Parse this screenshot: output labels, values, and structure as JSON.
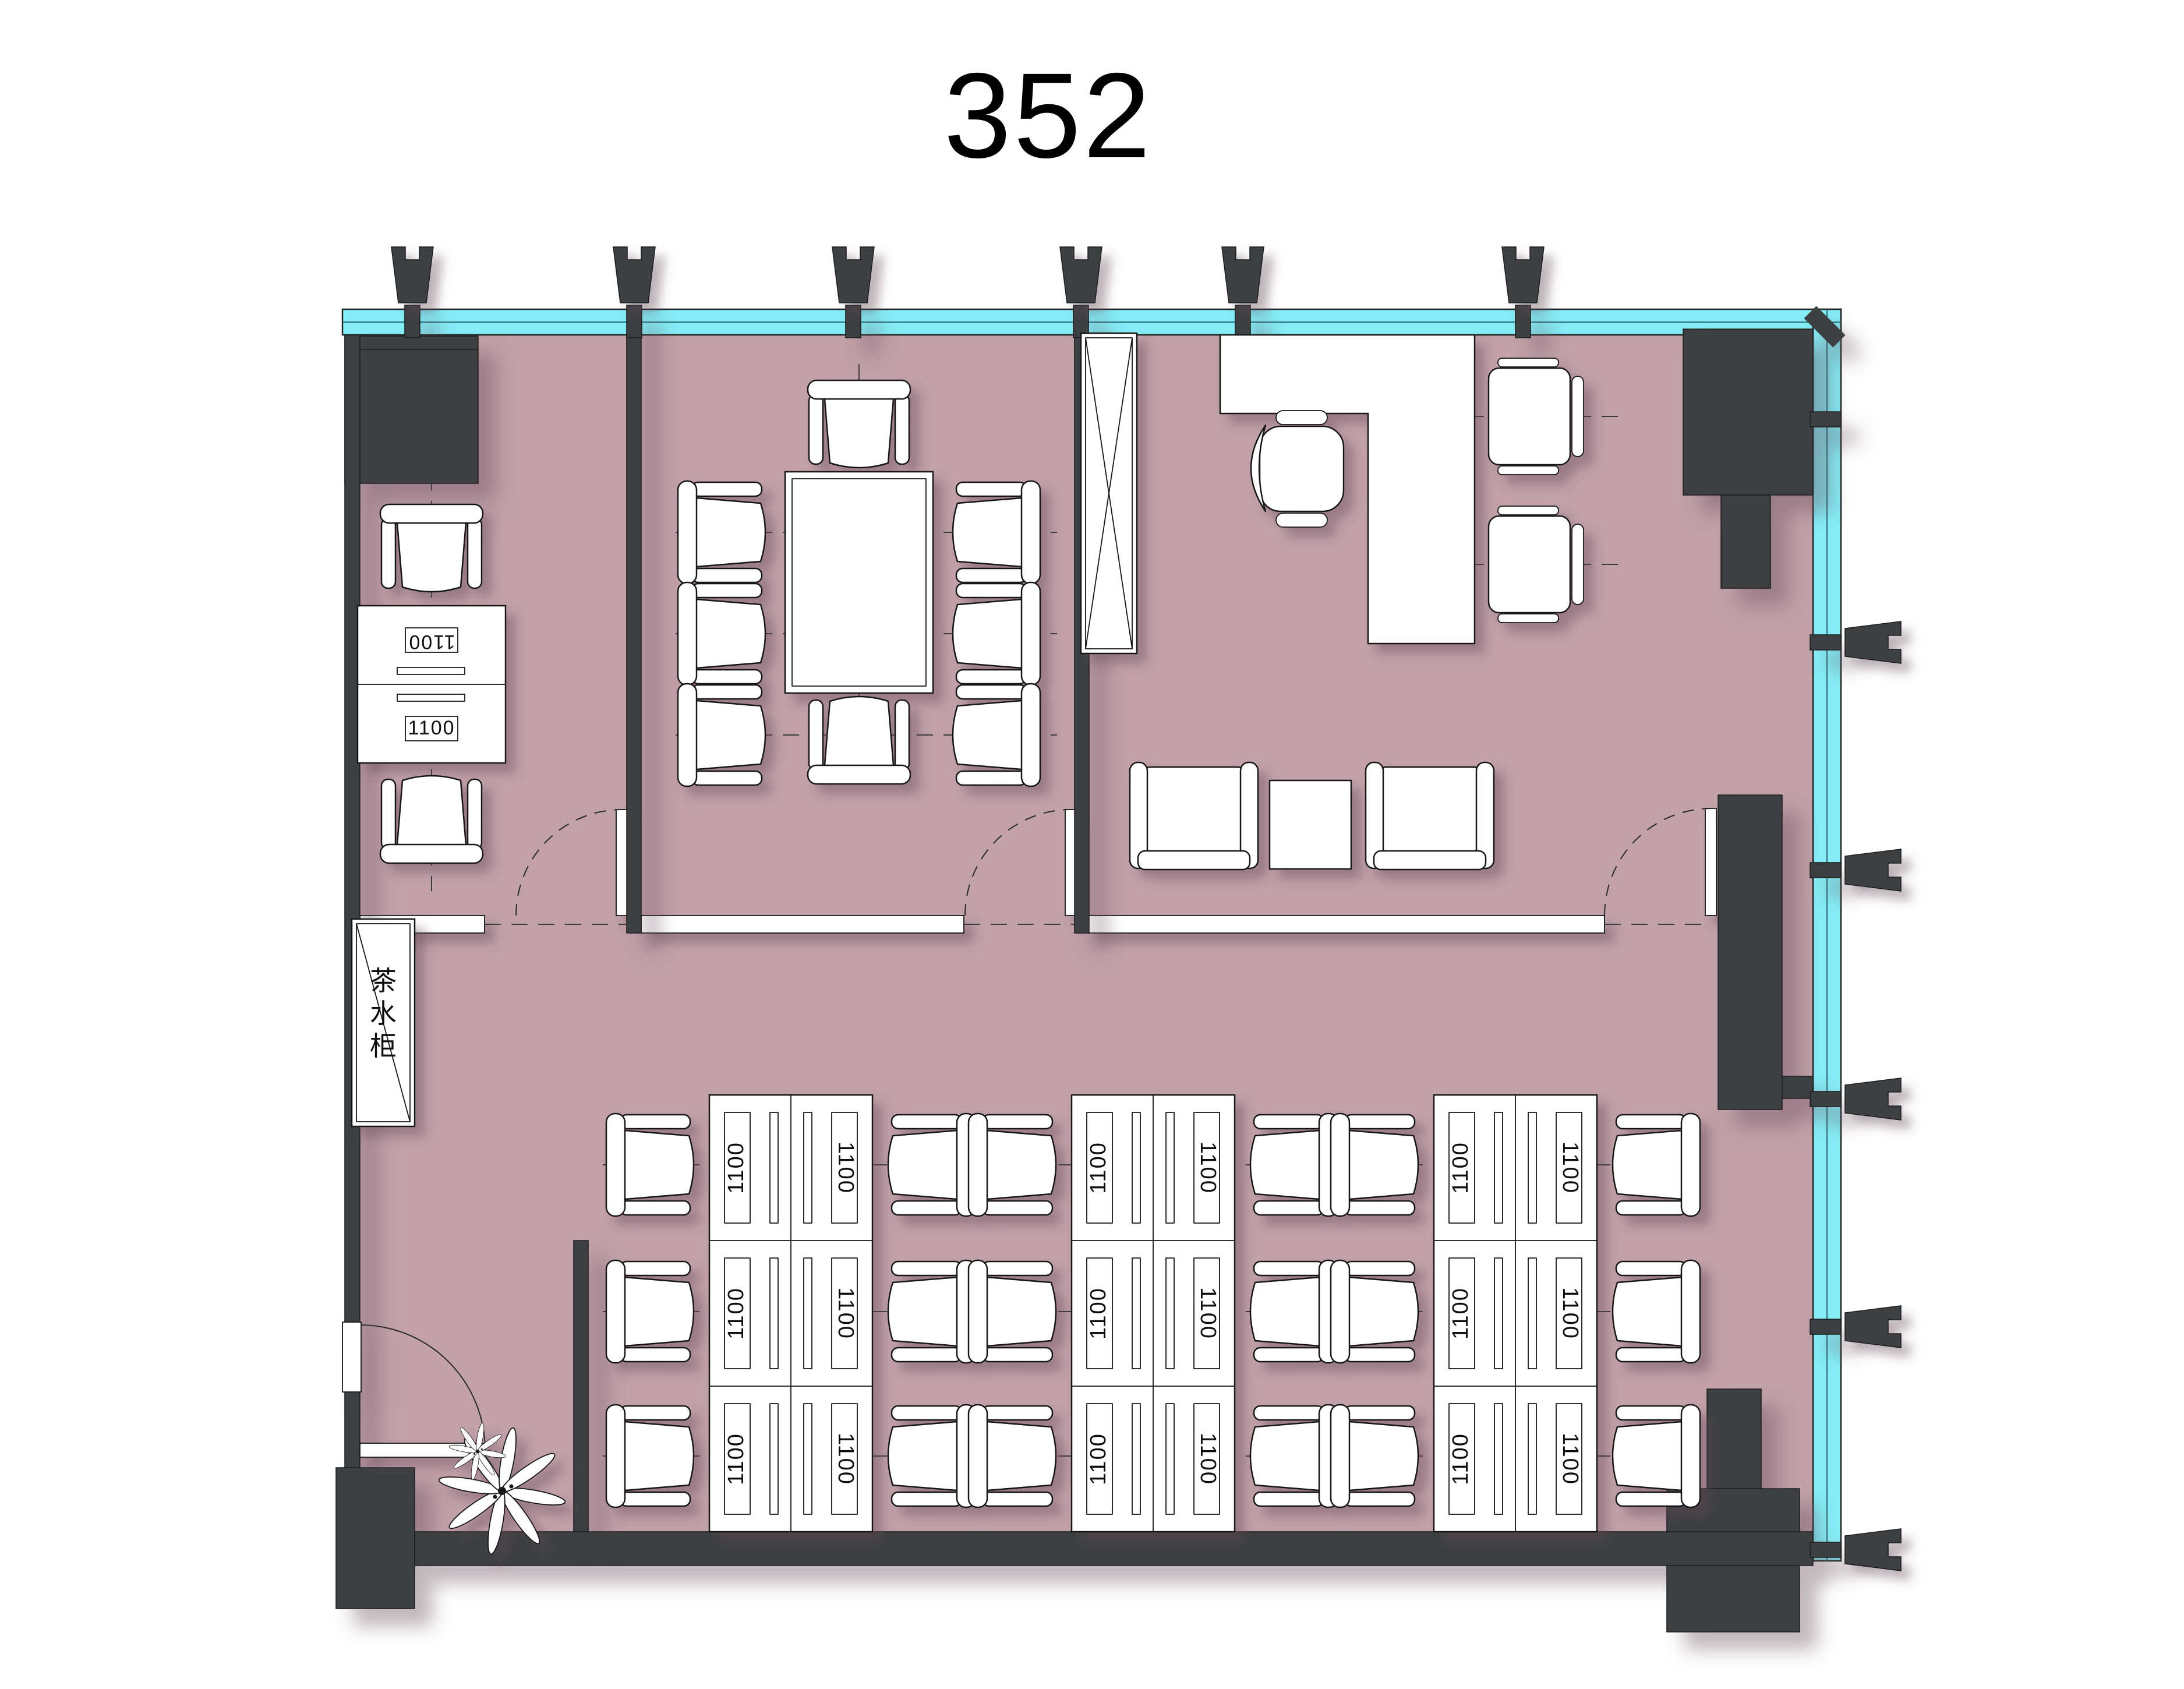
{
  "title": "352",
  "labels": {
    "desk_size": "1100",
    "tea_cabinet": "茶水柜",
    "tea_cabinet_chars": [
      "茶",
      "水",
      "柜"
    ]
  },
  "palette": {
    "floor": "#c2a1a9",
    "wall": "#3e3f42",
    "glass": "#85edf6",
    "outline": "#151515",
    "paper": "#ffffff",
    "shadow": "#634a56"
  }
}
